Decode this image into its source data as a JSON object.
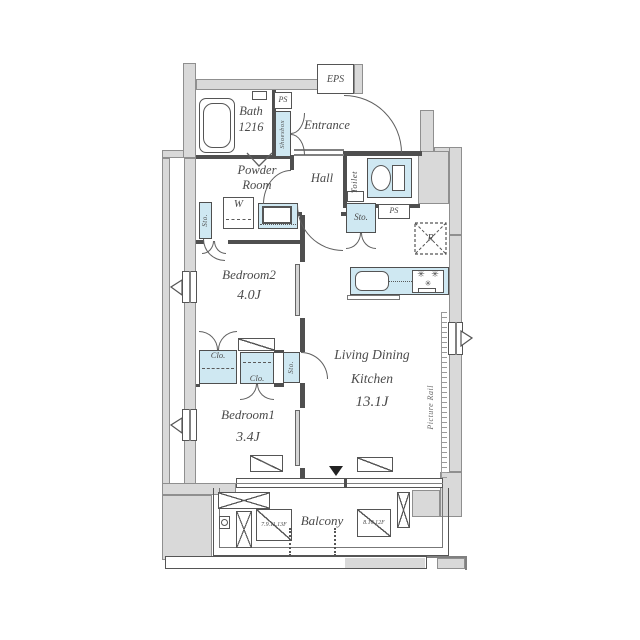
{
  "rooms": {
    "bath": {
      "name": "Bath",
      "size": "1216"
    },
    "entrance": {
      "name": "Entrance"
    },
    "powder": {
      "line1": "Powder",
      "line2": "Room"
    },
    "hall": {
      "name": "Hall"
    },
    "toilet": {
      "name": "Toilet"
    },
    "bedroom2": {
      "name": "Bedroom2",
      "size": "4.0J"
    },
    "bedroom1": {
      "name": "Bedroom1",
      "size": "3.4J"
    },
    "ldk": {
      "line1": "Living Dining",
      "line2": "Kitchen",
      "size": "13.1J"
    },
    "balcony": {
      "name": "Balcony"
    }
  },
  "labels": {
    "eps": "EPS",
    "ps_top": "PS",
    "ps_side": "PS",
    "shoesbox": "Shoesbox",
    "washer": "W",
    "sto_powder": "Sto.",
    "sto_hall": "Sto.",
    "sto_bedroom": "Sto.",
    "clo_left": "Clo.",
    "clo_mid": "Clo.",
    "fridge": "R",
    "picture_rail": "Picture Rail",
    "ac_left": "7.9.11.13F",
    "ac_right": "8.10.12F"
  },
  "icons": {
    "burner_glyph": "✳"
  },
  "colors": {
    "wall": "#d9d9d9",
    "fixture": "#cfe8f2",
    "line": "#4f4f4f"
  }
}
